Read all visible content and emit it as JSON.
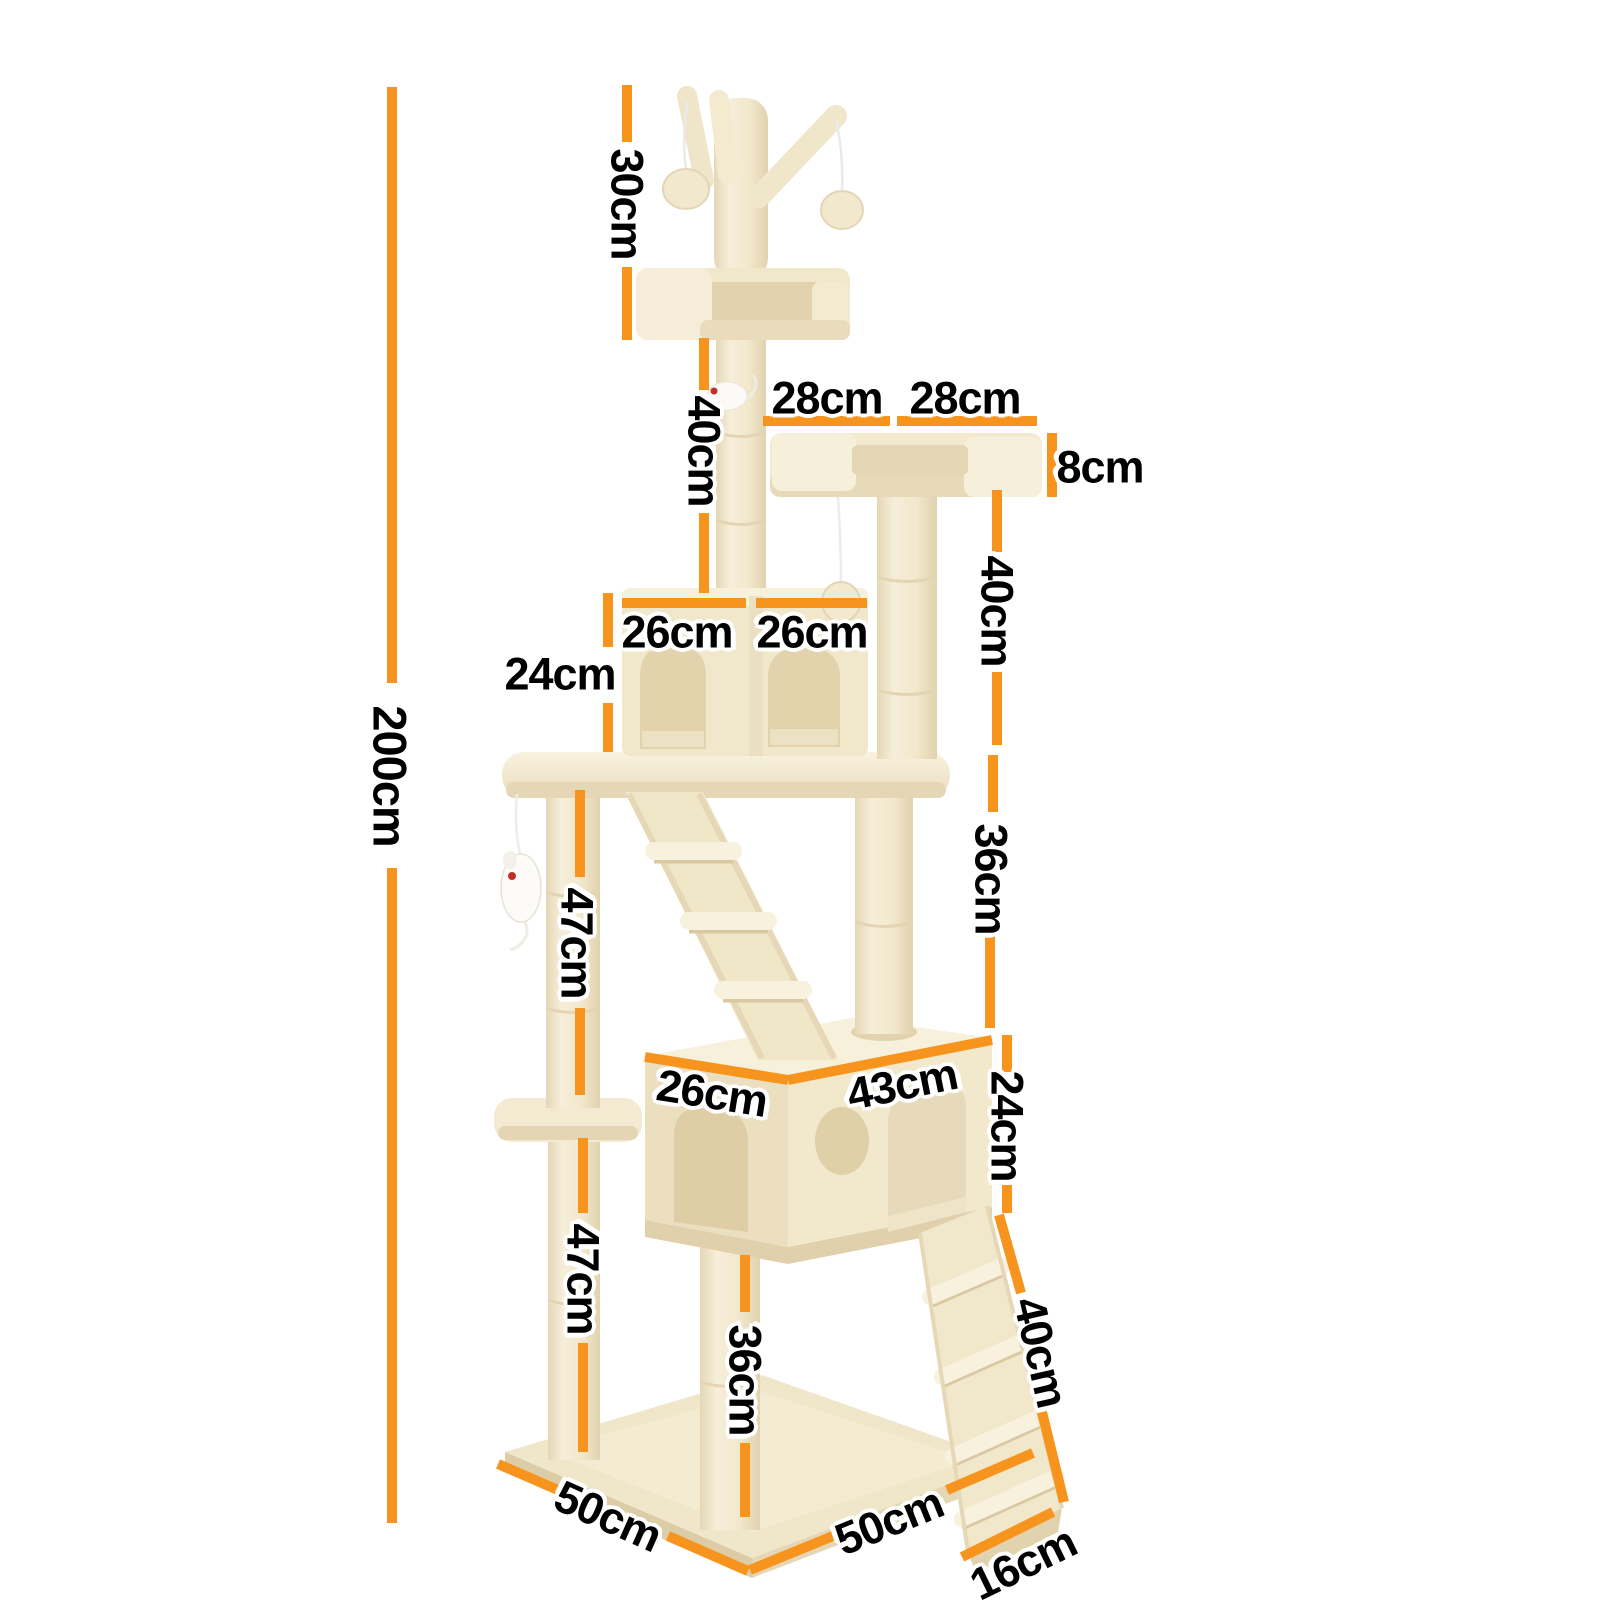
{
  "subject": "cat-tree-dimension-diagram",
  "accent_color": "#F7941E",
  "background_color": "#FFFFFF",
  "unit": "cm",
  "measurements": {
    "total_height": {
      "label": "200cm",
      "value": 200,
      "unit": "cm"
    },
    "top_section": {
      "label": "30cm",
      "value": 30,
      "unit": "cm"
    },
    "upper_post": {
      "label": "40cm",
      "value": 40,
      "unit": "cm"
    },
    "tray_left": {
      "label": "28cm",
      "value": 28,
      "unit": "cm"
    },
    "tray_right": {
      "label": "28cm",
      "value": 28,
      "unit": "cm"
    },
    "tray_thickness": {
      "label": "8cm",
      "value": 8,
      "unit": "cm"
    },
    "right_post_upper": {
      "label": "40cm",
      "value": 40,
      "unit": "cm"
    },
    "right_post_lower": {
      "label": "36cm",
      "value": 36,
      "unit": "cm"
    },
    "cubby_left": {
      "label": "26cm",
      "value": 26,
      "unit": "cm"
    },
    "cubby_right": {
      "label": "26cm",
      "value": 26,
      "unit": "cm"
    },
    "cubby_height": {
      "label": "24cm",
      "value": 24,
      "unit": "cm"
    },
    "left_post_upper": {
      "label": "47cm",
      "value": 47,
      "unit": "cm"
    },
    "left_post_lower": {
      "label": "47cm",
      "value": 47,
      "unit": "cm"
    },
    "condo_depth": {
      "label": "26cm",
      "value": 26,
      "unit": "cm"
    },
    "condo_width": {
      "label": "43cm",
      "value": 43,
      "unit": "cm"
    },
    "condo_height": {
      "label": "24cm",
      "value": 24,
      "unit": "cm"
    },
    "ramp_length": {
      "label": "40cm",
      "value": 40,
      "unit": "cm"
    },
    "bottom_post": {
      "label": "36cm",
      "value": 36,
      "unit": "cm"
    },
    "base_left": {
      "label": "50cm",
      "value": 50,
      "unit": "cm"
    },
    "base_right": {
      "label": "50cm",
      "value": 50,
      "unit": "cm"
    },
    "ramp_width": {
      "label": "16cm",
      "value": 16,
      "unit": "cm"
    }
  }
}
